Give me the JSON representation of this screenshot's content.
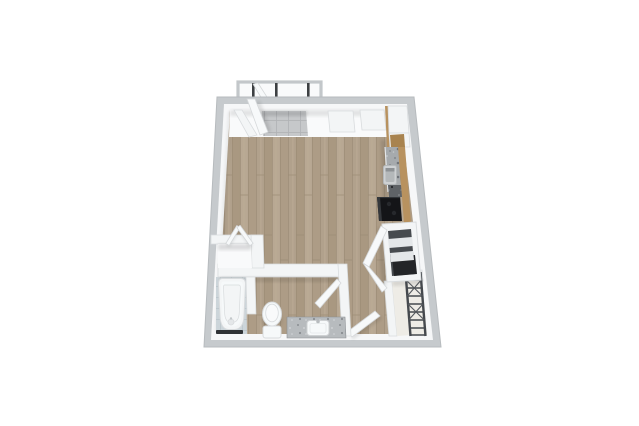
{
  "scene": {
    "title": "Studio apartment 3D top-down floor plan render",
    "view": "top-down 3D render, no visible text",
    "background": "#ffffff"
  },
  "fixtures": [
    "balcony-with-railing",
    "patio-door",
    "entry-closet-tile-floor",
    "window-niches",
    "corner-cabinet",
    "upper-cabinets",
    "kitchen-counter-granite",
    "kitchen-sink",
    "range",
    "pantry-shelf-unit",
    "closet-double-doors",
    "coat-closet-wire-shelving",
    "entry-door",
    "bathroom",
    "bathtub",
    "toilet",
    "vanity-sink",
    "bifold-closet"
  ],
  "palette": {
    "background": "#ffffff",
    "wall_fill": "#c6cacd",
    "wall_edge": "#b7bbbe",
    "wall_inner": "#f6f7f8",
    "strip_white": "#f9fafb",
    "wood_base": "#b1a18c",
    "wood_dark": "#a99881",
    "wood_mid": "#b8a893",
    "wood_alt": "#ad9c86",
    "wood_light": "#bcab95",
    "wood_line": "#9b8b75",
    "tile_base": "#c6c8ca",
    "tile_line": "#b1b3b6",
    "bath_tile_base": "#ccd5da",
    "bath_tile_line": "#bac4ca",
    "granite_base": "#a6aaad",
    "granite_dot_dark": "#70747a",
    "granite_dot_mid": "#888c90",
    "granite_dot_light": "#c6c9cb",
    "granite_dark_base": "#5f6367",
    "granite_dark_dot": "#7d8186",
    "vanity_granite_base": "#b7bbbe",
    "vanity_dot_dark": "#8a8e92",
    "vanity_dot_light": "#d4d7d9",
    "cabinet_wood": "#b8925f",
    "cabinet_wood_dark": "#a8834f",
    "appliance_black": "#141518",
    "appliance_gray": "#35383c",
    "burner_dark": "#26282c",
    "fixture_white": "#f6f9fa",
    "fixture_stroke": "#d8dbdd",
    "panel_white": "#f3f5f6",
    "panel_stroke": "#d9dcde",
    "door_fill": "#f7f9fa",
    "door_stroke": "#d5d8da",
    "shelf_cavity": "#474b4f",
    "shelf_cavity_dark": "#232528",
    "shelf_ledge": "#e4e7e9",
    "wire_rack": "#45494e",
    "wire_rack_light": "#54585d",
    "closet_floor_cream": "#eeece6",
    "threshold_dark": "#2f3235",
    "railing": "#c3c7ca",
    "post_dark": "#3c3f42",
    "sink_outer": "#ced1d3",
    "sink_inner": "#b4b8ba",
    "sink_shade": "#8e9295",
    "shadow": "#000000"
  }
}
